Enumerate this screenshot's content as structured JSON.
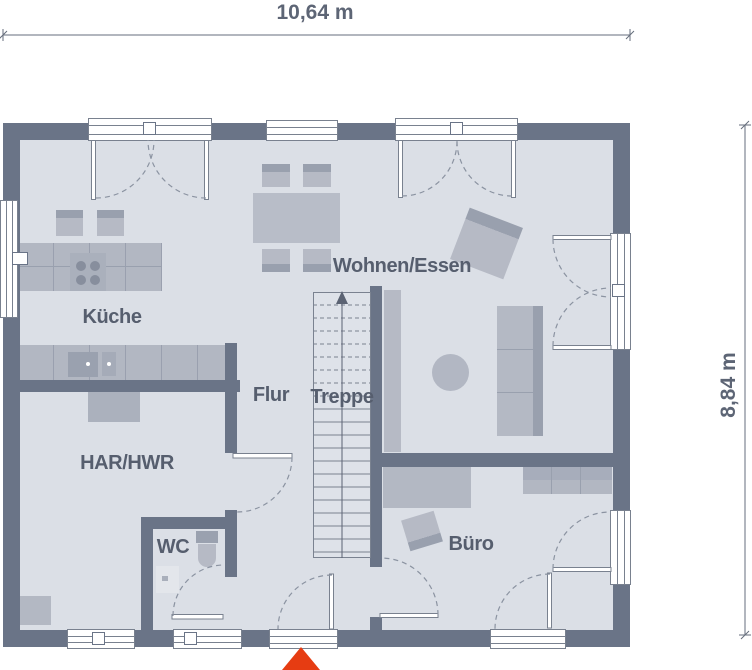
{
  "dimensions": {
    "width": "10,64 m",
    "height": "8,84 m"
  },
  "labels": {
    "kueche": "Küche",
    "wohnen_essen": "Wohnen/Essen",
    "flur": "Flur",
    "treppe": "Treppe",
    "har_hwr": "HAR/HWR",
    "wc": "WC",
    "buero": "Büro"
  },
  "icons": {
    "entrance_marker": "red-arrow-up",
    "stairs_direction": "arrow-up"
  },
  "colors": {
    "wall": "#6a7487",
    "floor": "#dbdfe6",
    "furniture": "#b6bac5",
    "furniture_dark": "#99a0ae",
    "accent_red": "#e63c12",
    "text": "#565e6e"
  }
}
